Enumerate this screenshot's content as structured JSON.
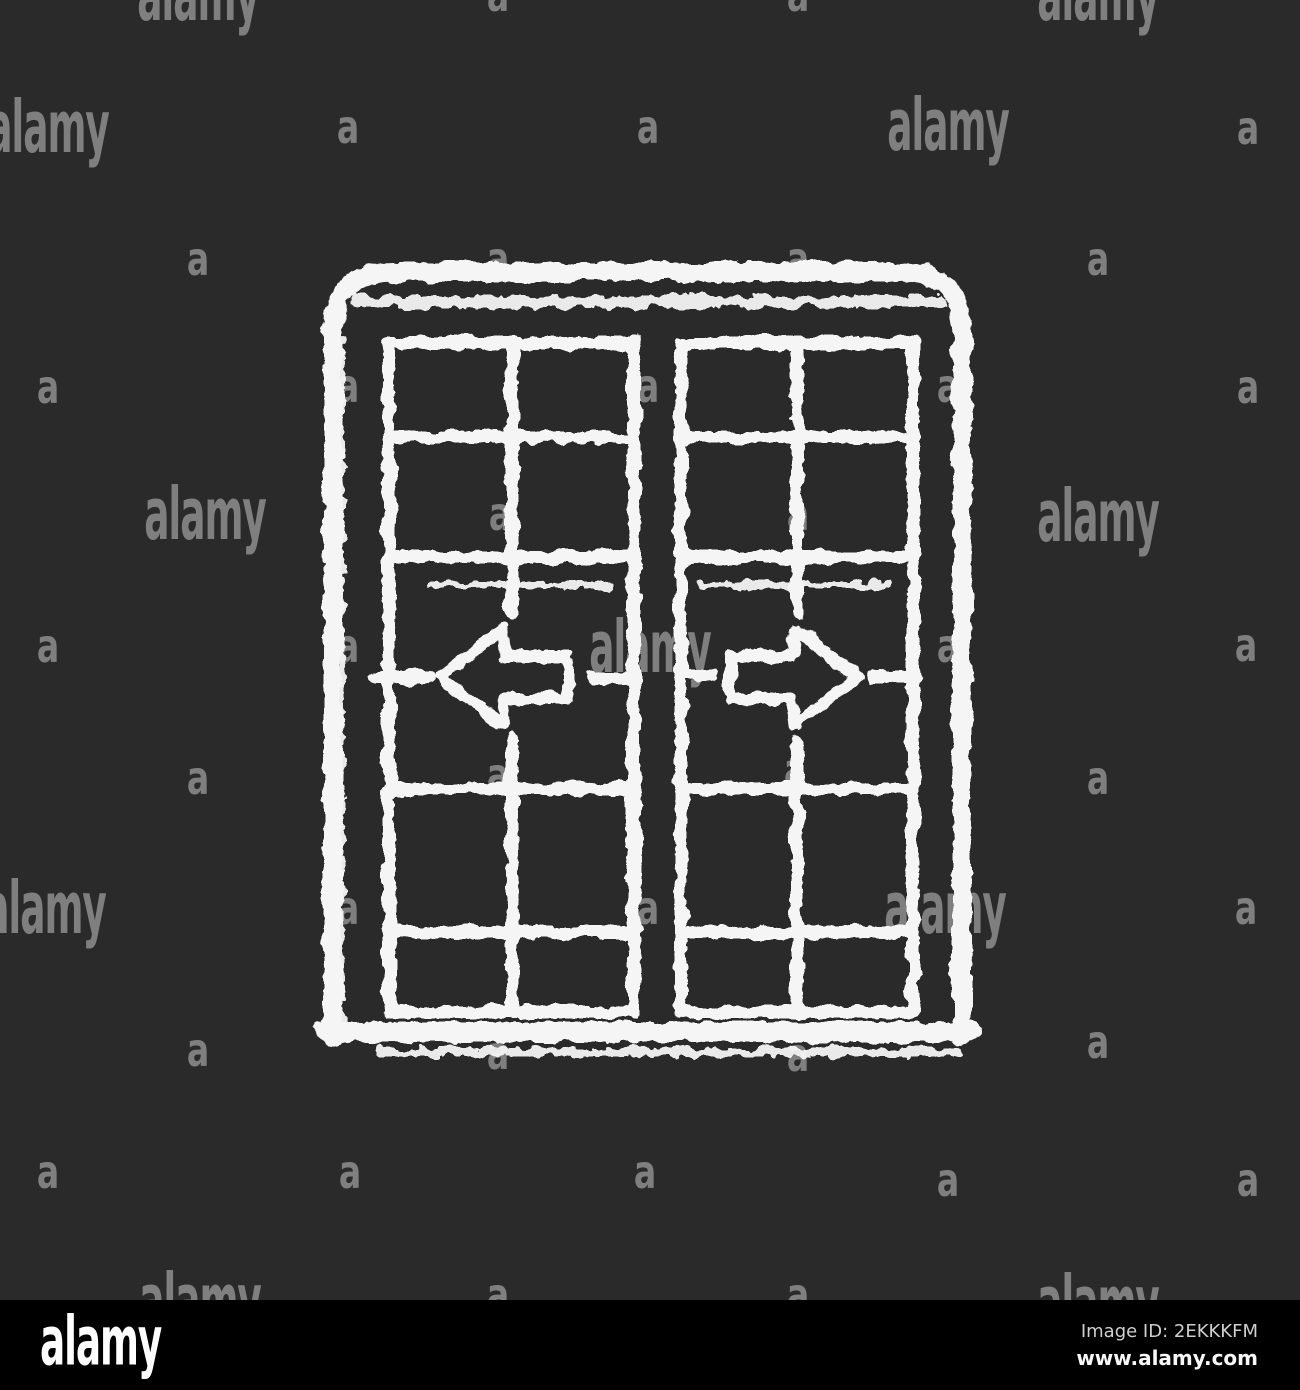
{
  "canvas": {
    "background_color": "#2a2a2a",
    "footer_background_color": "#000000",
    "icon_stroke_color": "#f5f5f5",
    "watermark_color": "rgba(255,255,255,0.40)"
  },
  "icon": {
    "semantic": "sliding-patio-doors-chalk-icon",
    "style": "chalk white icon on dark background",
    "arrows": [
      "left-arrow-icon",
      "right-arrow-icon"
    ]
  },
  "watermark": {
    "a_text": "a",
    "word_text": "alamy",
    "items": [
      {
        "t": "word",
        "x": 198,
        "y": -5
      },
      {
        "t": "a",
        "x": 498,
        "y": -5
      },
      {
        "t": "a",
        "x": 798,
        "y": -5
      },
      {
        "t": "word",
        "x": 1098,
        "y": -5
      },
      {
        "t": "word",
        "x": 48,
        "y": 127
      },
      {
        "t": "a",
        "x": 348,
        "y": 127
      },
      {
        "t": "a",
        "x": 648,
        "y": 127
      },
      {
        "t": "word",
        "x": 948,
        "y": 125
      },
      {
        "t": "a",
        "x": 1248,
        "y": 128
      },
      {
        "t": "a",
        "x": 198,
        "y": 259
      },
      {
        "t": "a",
        "x": 498,
        "y": 259
      },
      {
        "t": "a",
        "x": 798,
        "y": 259
      },
      {
        "t": "a",
        "x": 1098,
        "y": 259
      },
      {
        "t": "a",
        "x": 48,
        "y": 387
      },
      {
        "t": "a",
        "x": 348,
        "y": 386
      },
      {
        "t": "a",
        "x": 648,
        "y": 386
      },
      {
        "t": "a",
        "x": 948,
        "y": 386
      },
      {
        "t": "a",
        "x": 1248,
        "y": 387
      },
      {
        "t": "word",
        "x": 205,
        "y": 514
      },
      {
        "t": "a",
        "x": 500,
        "y": 514
      },
      {
        "t": "a",
        "x": 798,
        "y": 514
      },
      {
        "t": "word",
        "x": 1098,
        "y": 516
      },
      {
        "t": "a",
        "x": 48,
        "y": 646
      },
      {
        "t": "a",
        "x": 348,
        "y": 646
      },
      {
        "t": "word",
        "x": 650,
        "y": 647
      },
      {
        "t": "a",
        "x": 948,
        "y": 646
      },
      {
        "t": "a",
        "x": 1246,
        "y": 645
      },
      {
        "t": "a",
        "x": 198,
        "y": 778
      },
      {
        "t": "a",
        "x": 498,
        "y": 775
      },
      {
        "t": "a",
        "x": 795,
        "y": 770
      },
      {
        "t": "a",
        "x": 1098,
        "y": 778
      },
      {
        "t": "word",
        "x": 45,
        "y": 908
      },
      {
        "t": "a",
        "x": 348,
        "y": 908
      },
      {
        "t": "a",
        "x": 648,
        "y": 908
      },
      {
        "t": "word",
        "x": 945,
        "y": 908
      },
      {
        "t": "a",
        "x": 1246,
        "y": 908
      },
      {
        "t": "a",
        "x": 198,
        "y": 1050
      },
      {
        "t": "a",
        "x": 498,
        "y": 1053
      },
      {
        "t": "a",
        "x": 798,
        "y": 1055
      },
      {
        "t": "a",
        "x": 1098,
        "y": 1042
      },
      {
        "t": "a",
        "x": 48,
        "y": 1172
      },
      {
        "t": "a",
        "x": 350,
        "y": 1172
      },
      {
        "t": "a",
        "x": 645,
        "y": 1172
      },
      {
        "t": "a",
        "x": 948,
        "y": 1180
      },
      {
        "t": "a",
        "x": 1248,
        "y": 1180
      },
      {
        "t": "word",
        "x": 200,
        "y": 1300
      },
      {
        "t": "a",
        "x": 498,
        "y": 1295
      },
      {
        "t": "a",
        "x": 798,
        "y": 1295
      },
      {
        "t": "word",
        "x": 1098,
        "y": 1302
      }
    ]
  },
  "footer": {
    "logo": "alamy",
    "image_id_label": "Image ID: 2EKKKFM",
    "url": "www.alamy.com"
  }
}
